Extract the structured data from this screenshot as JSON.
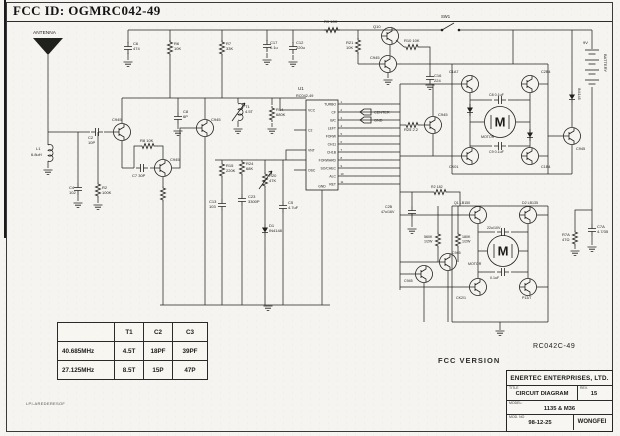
{
  "header": {
    "fcc_id": "FCC ID: OGMRC042-49"
  },
  "footer": {
    "fcc_version": "FCC VERSION",
    "board_code": "RC042C-49",
    "side_note": "LPI-AREDERESOF"
  },
  "title_block": {
    "company": "ENERTEC ENTERPRISES, LTD.",
    "title_label": "TITLE",
    "title": "CIRCUIT DIAGRAM",
    "rev_label": "REV.",
    "rev": "15",
    "model_label": "MODEL:",
    "model": "1135 & M36",
    "mod_no_label": "MOD. NO",
    "date": "98-12-25",
    "engineer": "WONGFEI"
  },
  "freq_table": {
    "col_headers": [
      "T1",
      "C2",
      "C3"
    ],
    "rows": [
      {
        "freq": "40.685MHz",
        "t1": "4.5T",
        "c2": "18PF",
        "c3": "39PF"
      },
      {
        "freq": "27.125MHz",
        "t1": "8.5T",
        "c2": "15P",
        "c3": "47P"
      }
    ]
  },
  "ic": {
    "ref": "U1",
    "part": "RC042-49",
    "x": 306,
    "y": 100,
    "w": 32,
    "h": 90,
    "right_pins": [
      "TURBO",
      "CF",
      "B/C",
      "LEFT",
      "FORW",
      "CH11",
      "CH1B",
      "FORWARD",
      "SO/CHEC",
      "ALC",
      "RET"
    ],
    "left_pins": [
      "VCC",
      "C2",
      "VNT",
      "OSC"
    ],
    "left_ys": [
      110,
      130,
      150,
      170
    ],
    "bottom_pin": "GND"
  },
  "callouts": {
    "items": [
      "CENTER",
      "GND"
    ],
    "flag_positions": [
      [
        366,
        112
      ],
      [
        366,
        120
      ]
    ]
  },
  "battery": {
    "label": "BATTERY",
    "voltage": "9V",
    "x": 592,
    "y_top": 50,
    "pairs": 4
  },
  "motors": {
    "symbol": "M",
    "label": "MOTOR",
    "positions": [
      [
        500,
        122
      ],
      [
        503,
        251
      ]
    ],
    "label_positions": [
      [
        481,
        138
      ],
      [
        468,
        265
      ]
    ]
  },
  "switch": {
    "label": "SW1",
    "label_pos": [
      441,
      18
    ],
    "circles": [
      [
        442,
        30
      ],
      [
        459,
        30
      ]
    ],
    "blade": "442,30 454,23"
  },
  "schematic": {
    "wires": [
      "128,30 442,30",
      "460,30 592,30",
      "128,30 128,43",
      "128,53 128,60",
      "170,30 170,42",
      "170,56 170,98",
      "222,30 222,42",
      "222,56 222,98",
      "267,30 267,41",
      "267,53 267,58",
      "293,30 293,43",
      "293,55 293,60",
      "358,30 358,39",
      "358,53 358,64",
      "390,45 390,55",
      "396,40 404,47",
      "420,47 430,47 430,64",
      "430,64 430,72",
      "379,64 358,64",
      "397,64 452,64",
      "388,73 388,78",
      "513,30 513,64",
      "452,64 548,64",
      "452,64 452,174",
      "548,64 548,174",
      "452,174 548,174",
      "539,84 548,84",
      "539,156 548,156",
      "470,93 470,147",
      "530,93 530,147",
      "470,122 484,122",
      "516,122 530,122",
      "470,100 492,100",
      "508,100 530,100",
      "470,146 492,146",
      "508,146 530,146",
      "400,84 400,290",
      "400,84 461,84",
      "400,156 461,156",
      "400,125 404,125",
      "420,125 424,125",
      "433,116 433,84",
      "433,134 433,156",
      "400,215 469,215",
      "400,287 469,287",
      "537,215 548,215",
      "537,287 548,287",
      "452,206 548,206",
      "452,206 452,322",
      "548,206 548,322",
      "452,322 548,322",
      "500,322 500,330",
      "478,224 478,278",
      "528,224 528,278",
      "478,251 487,251",
      "519,251 528,251",
      "478,232 495,232",
      "511,232 528,232",
      "478,272 495,272",
      "511,272 528,272",
      "400,262 439,262",
      "400,274 415,274",
      "438,206 438,232",
      "438,248 438,262",
      "458,206 458,232",
      "458,248 458,262",
      "448,271 448,322",
      "424,283 424,322",
      "400,192 432,192",
      "448,192 460,192 460,206",
      "412,192 412,206",
      "412,218 412,227",
      "572,30 572,91",
      "572,103 572,127",
      "572,145 572,174",
      "548,174 572,174",
      "563,136 548,136",
      "592,30 592,49",
      "592,87 592,224",
      "592,236 592,245",
      "592,210 575,210 575,230",
      "575,246 575,249",
      "48,55 48,132",
      "48,132 90,132",
      "104,132 113,132",
      "48,132 48,145",
      "48,161 48,168",
      "122,123 122,98",
      "122,141 122,168",
      "122,168 134,168",
      "150,168 154,168",
      "134,168 134,146 140,146",
      "156,146 163,146 163,159",
      "172,168 180,168 180,128 196,128",
      "163,177 163,186",
      "163,202 163,305",
      "205,119 205,98",
      "205,137 205,305",
      "122,98 306,98",
      "178,98 178,112",
      "178,124 178,129",
      "238,98 238,103",
      "238,121 238,127",
      "272,98 272,105",
      "272,123 272,127",
      "98,132 98,182",
      "98,198 98,203",
      "78,132 78,183",
      "78,195 78,201",
      "215,160 306,160",
      "222,160 222,162",
      "222,178 222,199",
      "222,211 222,305",
      "242,176 242,194",
      "242,206 242,305",
      "265,160 265,172",
      "265,188 265,224",
      "265,236 265,305",
      "283,160 283,201",
      "283,213 283,305",
      "294,110 280,110 280,98",
      "294,150 286,150 286,160",
      "322,190 322,305",
      "160,305 330,305"
    ],
    "resistors_v": [
      [
        170,
        48
      ],
      [
        222,
        48
      ],
      [
        358,
        46
      ],
      [
        163,
        194
      ],
      [
        222,
        170
      ],
      [
        242,
        168
      ],
      [
        272,
        114
      ],
      [
        98,
        190
      ],
      [
        438,
        240
      ],
      [
        458,
        240
      ],
      [
        575,
        238
      ]
    ],
    "resistors_h": [
      [
        412,
        47
      ],
      [
        148,
        146
      ],
      [
        412,
        125
      ],
      [
        440,
        192
      ],
      [
        332,
        30
      ]
    ],
    "caps_v": [
      [
        128,
        48
      ],
      [
        267,
        46
      ],
      [
        293,
        48
      ],
      [
        430,
        78
      ],
      [
        78,
        189
      ],
      [
        178,
        118
      ],
      [
        222,
        205
      ],
      [
        242,
        200
      ],
      [
        283,
        207
      ],
      [
        412,
        212
      ],
      [
        592,
        230
      ]
    ],
    "caps_h": [
      [
        97,
        132
      ],
      [
        142,
        168
      ],
      [
        500,
        100
      ],
      [
        500,
        146
      ],
      [
        503,
        232
      ],
      [
        503,
        272
      ]
    ],
    "transistors": [
      [
        390,
        36
      ],
      [
        388,
        64
      ],
      [
        122,
        132
      ],
      [
        163,
        168
      ],
      [
        205,
        128
      ],
      [
        433,
        125
      ],
      [
        470,
        84
      ],
      [
        530,
        84
      ],
      [
        470,
        156
      ],
      [
        530,
        156
      ],
      [
        572,
        136
      ],
      [
        478,
        215
      ],
      [
        528,
        215
      ],
      [
        478,
        287
      ],
      [
        528,
        287
      ],
      [
        448,
        262
      ],
      [
        424,
        274
      ]
    ],
    "diodes": [
      [
        265,
        230
      ],
      [
        572,
        97
      ],
      [
        470,
        110
      ],
      [
        530,
        135
      ]
    ],
    "grounds": [
      [
        128,
        62
      ],
      [
        267,
        60
      ],
      [
        293,
        62
      ],
      [
        388,
        80
      ],
      [
        430,
        85
      ],
      [
        48,
        170
      ],
      [
        78,
        203
      ],
      [
        98,
        205
      ],
      [
        178,
        131
      ],
      [
        238,
        129
      ],
      [
        272,
        129
      ],
      [
        268,
        306
      ],
      [
        500,
        331
      ],
      [
        412,
        229
      ],
      [
        575,
        251
      ],
      [
        592,
        247
      ]
    ],
    "coils": [
      [
        48,
        153
      ]
    ],
    "trimmers": [
      [
        238,
        112
      ]
    ],
    "varres": [
      [
        265,
        180
      ]
    ],
    "labels": [
      {
        "t": "ANTENNA",
        "x": 33,
        "y": 34,
        "s": 4.8
      },
      {
        "t": "C6",
        "x": 133,
        "y": 45
      },
      {
        "t": "474",
        "x": 133,
        "y": 50
      },
      {
        "t": "R6",
        "x": 174,
        "y": 45
      },
      {
        "t": "10K",
        "x": 174,
        "y": 50
      },
      {
        "t": "R7",
        "x": 226,
        "y": 45
      },
      {
        "t": "33K",
        "x": 226,
        "y": 50
      },
      {
        "t": "C17",
        "x": 270,
        "y": 44
      },
      {
        "t": "0.1u",
        "x": 270,
        "y": 49
      },
      {
        "t": "C12",
        "x": 296,
        "y": 44
      },
      {
        "t": "220u",
        "x": 296,
        "y": 49
      },
      {
        "t": "R9 10K",
        "x": 324,
        "y": 23
      },
      {
        "t": "Q10",
        "x": 373,
        "y": 28
      },
      {
        "t": "R10 10K",
        "x": 404,
        "y": 42
      },
      {
        "t": "R21",
        "x": 346,
        "y": 44
      },
      {
        "t": "10K",
        "x": 346,
        "y": 49
      },
      {
        "t": "C945",
        "x": 370,
        "y": 59
      },
      {
        "t": "C16",
        "x": 434,
        "y": 77
      },
      {
        "t": "224",
        "x": 434,
        "y": 82
      },
      {
        "t": "C2",
        "x": 88,
        "y": 139
      },
      {
        "t": "10P",
        "x": 88,
        "y": 144
      },
      {
        "t": "C945",
        "x": 112,
        "y": 121
      },
      {
        "t": "L1",
        "x": 36,
        "y": 150
      },
      {
        "t": "6.8uH",
        "x": 31,
        "y": 156
      },
      {
        "t": "C4",
        "x": 69,
        "y": 189
      },
      {
        "t": "102",
        "x": 69,
        "y": 194
      },
      {
        "t": "R2",
        "x": 102,
        "y": 189
      },
      {
        "t": "100K",
        "x": 102,
        "y": 194
      },
      {
        "t": "R8 10K",
        "x": 140,
        "y": 142
      },
      {
        "t": "C7 30P",
        "x": 132,
        "y": 177
      },
      {
        "t": "C945",
        "x": 170,
        "y": 161
      },
      {
        "t": "C8",
        "x": 183,
        "y": 113
      },
      {
        "t": "6P",
        "x": 183,
        "y": 118
      },
      {
        "t": "C945",
        "x": 211,
        "y": 121
      },
      {
        "t": "T1",
        "x": 245,
        "y": 108
      },
      {
        "t": "4.5T",
        "x": 245,
        "y": 113
      },
      {
        "t": "R14",
        "x": 276,
        "y": 111
      },
      {
        "t": "680K",
        "x": 276,
        "y": 116
      },
      {
        "t": "R15",
        "x": 226,
        "y": 167
      },
      {
        "t": "220K",
        "x": 226,
        "y": 172
      },
      {
        "t": "R24",
        "x": 246,
        "y": 165
      },
      {
        "t": "68K",
        "x": 246,
        "y": 170
      },
      {
        "t": "R20",
        "x": 269,
        "y": 177
      },
      {
        "t": "47K",
        "x": 269,
        "y": 182
      },
      {
        "t": "C13",
        "x": 209,
        "y": 203
      },
      {
        "t": "103",
        "x": 209,
        "y": 208
      },
      {
        "t": "C23",
        "x": 248,
        "y": 198
      },
      {
        "t": "3300P",
        "x": 248,
        "y": 203
      },
      {
        "t": "C5",
        "x": 288,
        "y": 204
      },
      {
        "t": "4.7uF",
        "x": 288,
        "y": 209
      },
      {
        "t": "D1",
        "x": 269,
        "y": 227
      },
      {
        "t": "IN4148",
        "x": 269,
        "y": 232
      },
      {
        "t": "R25 2.2",
        "x": 404,
        "y": 131
      },
      {
        "t": "C945",
        "x": 438,
        "y": 116
      },
      {
        "t": "C1A7",
        "x": 449,
        "y": 73,
        "s": 3.8
      },
      {
        "t": "C2B4",
        "x": 541,
        "y": 73,
        "s": 3.8
      },
      {
        "t": "CK01",
        "x": 449,
        "y": 168,
        "s": 3.8
      },
      {
        "t": "C1B4",
        "x": 541,
        "y": 168,
        "s": 3.8
      },
      {
        "t": "C8 0.1uF",
        "x": 489,
        "y": 96,
        "s": 3.6
      },
      {
        "t": "C9 0.1uF",
        "x": 489,
        "y": 153,
        "s": 3.6
      },
      {
        "t": "IN4148",
        "x": 578,
        "y": 88,
        "r": 90,
        "s": 3.6
      },
      {
        "t": "C945",
        "x": 576,
        "y": 150,
        "s": 3.8
      },
      {
        "t": "C7A",
        "x": 597,
        "y": 228
      },
      {
        "t": "4.7/35",
        "x": 597,
        "y": 233
      },
      {
        "t": "R7A",
        "x": 562,
        "y": 236
      },
      {
        "t": "47Ω",
        "x": 562,
        "y": 241
      },
      {
        "t": "Q1 LB150",
        "x": 454,
        "y": 204,
        "s": 3.6
      },
      {
        "t": "D2 LB135",
        "x": 522,
        "y": 204,
        "s": 3.6
      },
      {
        "t": "CK2/1",
        "x": 456,
        "y": 299,
        "s": 3.6
      },
      {
        "t": "P13/7",
        "x": 522,
        "y": 299,
        "s": 3.6
      },
      {
        "t": "22u/10V",
        "x": 487,
        "y": 229,
        "s": 3.6
      },
      {
        "t": "0.1uF",
        "x": 490,
        "y": 279,
        "s": 3.6
      },
      {
        "t": "560K",
        "x": 424,
        "y": 238,
        "s": 3.6
      },
      {
        "t": "1/2W",
        "x": 424,
        "y": 242.5,
        "s": 3.6
      },
      {
        "t": "180K",
        "x": 462,
        "y": 238,
        "s": 3.6
      },
      {
        "t": "1/2W",
        "x": 462,
        "y": 242.5,
        "s": 3.6
      },
      {
        "t": "C2B",
        "x": 385,
        "y": 208,
        "s": 3.6
      },
      {
        "t": "47u/16V",
        "x": 381,
        "y": 213,
        "s": 3.6
      },
      {
        "t": "R2 182",
        "x": 431,
        "y": 188,
        "s": 3.6
      },
      {
        "t": "C945",
        "x": 452,
        "y": 254,
        "s": 3.6
      },
      {
        "t": "C945",
        "x": 404,
        "y": 282,
        "s": 3.6
      },
      {
        "t": "U1",
        "x": 298,
        "y": 90,
        "s": 4.5
      },
      {
        "t": "RC042-49",
        "x": 296,
        "y": 97,
        "s": 3.8
      }
    ]
  }
}
